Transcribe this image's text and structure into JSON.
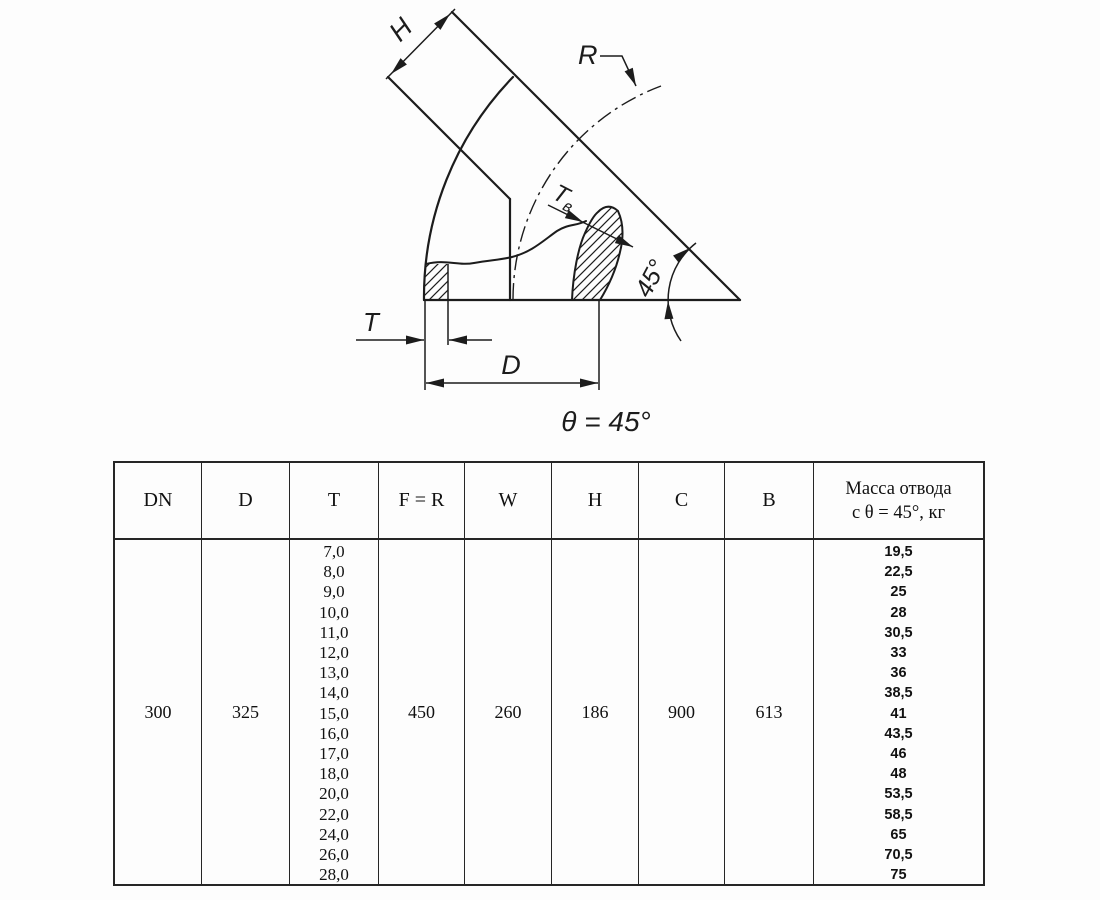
{
  "drawing": {
    "labels": {
      "h": "H",
      "r": "R",
      "tv_main": "T",
      "tv_sub": "в",
      "t": "T",
      "d": "D",
      "angle": "45°",
      "theta_caption": "θ = 45°"
    },
    "colors": {
      "ink": "#1c1c1c"
    }
  },
  "table": {
    "col_headers": [
      "DN",
      "D",
      "T",
      "F = R",
      "W",
      "H",
      "C",
      "B"
    ],
    "mass_header_line1": "Масса отвода",
    "mass_header_line2": "с θ = 45°, кг",
    "row": {
      "dn": "300",
      "d": "325",
      "f_r": "450",
      "w": "260",
      "h": "186",
      "c": "900",
      "b": "613"
    },
    "t_values": [
      "7,0",
      "8,0",
      "9,0",
      "10,0",
      "11,0",
      "12,0",
      "13,0",
      "14,0",
      "15,0",
      "16,0",
      "17,0",
      "18,0",
      "20,0",
      "22,0",
      "24,0",
      "26,0",
      "28,0"
    ],
    "mass_values": [
      "19,5",
      "22,5",
      "25",
      "28",
      "30,5",
      "33",
      "36",
      "38,5",
      "41",
      "43,5",
      "46",
      "48",
      "53,5",
      "58,5",
      "65",
      "70,5",
      "75"
    ]
  }
}
